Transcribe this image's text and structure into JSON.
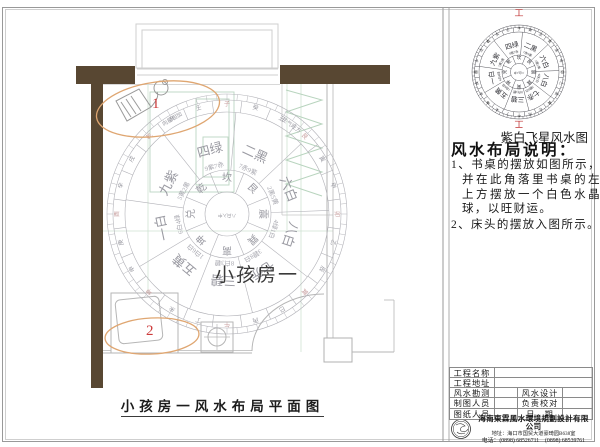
{
  "plan": {
    "room_label": "小孩房一",
    "title": "小孩房一风水布局平面图",
    "markers": [
      "1",
      "2"
    ],
    "compass": {
      "sectors": [
        {
          "star": "四绿",
          "sub": "9紫7赤",
          "angle": -15
        },
        {
          "star": "二黑",
          "sub": "7赤9紫",
          "angle": 25
        },
        {
          "star": "六白",
          "sub": "2黑5黄",
          "angle": 68
        },
        {
          "star": "八白",
          "sub": "4绿1白",
          "angle": 108
        },
        {
          "star": "七赤",
          "sub": "3碧8白",
          "angle": 148
        },
        {
          "star": "三碧",
          "sub": "8白3碧",
          "angle": 183
        },
        {
          "star": "五黄",
          "sub": "1白6白",
          "angle": 220
        },
        {
          "star": "一白",
          "sub": "6白4绿",
          "angle": 258
        },
        {
          "star": "九紫",
          "sub": "5黄2黑",
          "angle": 298
        }
      ],
      "trigrams": [
        "坎",
        "艮",
        "震",
        "巽",
        "离",
        "坤",
        "兑",
        "乾"
      ],
      "mountains": "子癸丑艮寅甲卯乙辰巽巳丙午丁未坤申庚酉辛戌乾亥壬",
      "red_mountains": "子午卯酉艮巽坤乾",
      "center_text": "八白入中",
      "annotations": [
        {
          "text": "向星相加",
          "angle": -30
        },
        {
          "text": "生气旺方",
          "angle": 36
        }
      ],
      "direction_mark": "工"
    }
  },
  "panel": {
    "small_compass_caption": "紫白飞星风水图",
    "instructions_title": "风水布局说明：",
    "instructions": [
      "1、书桌的摆放如图所示，并在此角落里书桌的左上方摆放一个白色水晶球，以旺财运。",
      "2、床头的摆放入图所示。"
    ],
    "title_block": {
      "rows": [
        {
          "label": "工程名称",
          "value": ""
        },
        {
          "label": "工程地址",
          "value": ""
        },
        {
          "label": "风水勘测",
          "value": "",
          "label2": "风水设计",
          "value2": ""
        },
        {
          "label": "制图人员",
          "value": "",
          "label2": "负责校对",
          "value2": ""
        },
        {
          "label": "图纸人员",
          "value": "",
          "label2": "日　期",
          "value2": ""
        }
      ],
      "company": "海南東霖風水環境規劃設計有限公司",
      "address": "地址：海口市国贸大道豪琦园B638室",
      "phone": "电话：(0898) 68526711　(0898) 68539761"
    }
  },
  "colors": {
    "wall": "#584732",
    "border": "#999999",
    "compass_big_stroke": "#b2b2b8",
    "compass_big_text": "#9a9aa2",
    "compass_small_stroke": "#55555c",
    "compass_small_text": "#2e2e34",
    "red_accent": "#c03434",
    "marker_red": "#cc3a3a",
    "ellipse_orange": "#dfa671",
    "furniture_green": "#bcd6c2",
    "furniture_gray": "#b6b6b6"
  }
}
